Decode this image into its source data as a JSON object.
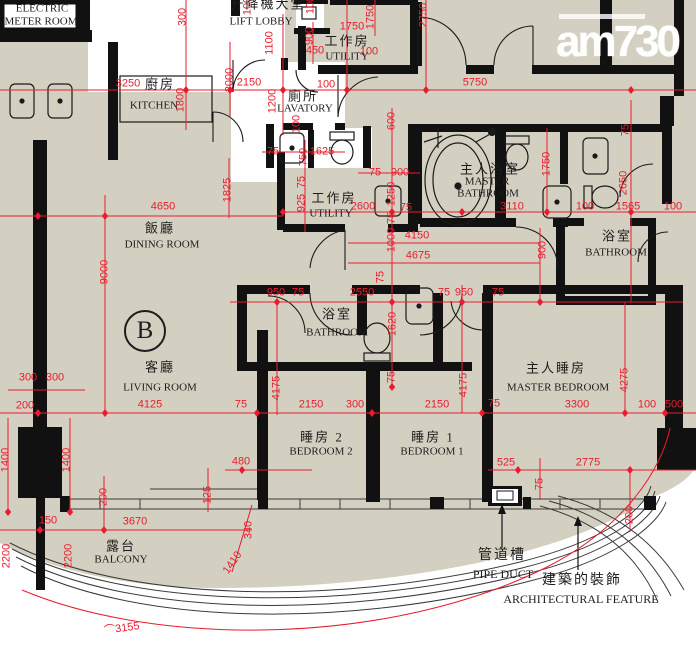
{
  "logo": {
    "text": "am730"
  },
  "unit_badge": {
    "text": "B"
  },
  "colors": {
    "floor": "#d4d0c1",
    "wall": "#111111",
    "dimension_red": "#ea1b2d",
    "logo_white": "#ffffff"
  },
  "rooms": [
    {
      "t": "ELECTRIC",
      "x": 42,
      "y": 9,
      "c": "en"
    },
    {
      "t": "METER ROOM",
      "x": 41,
      "y": 22,
      "c": "en"
    },
    {
      "t": "升降機大堂",
      "x": 268,
      "y": 4,
      "c": "zh"
    },
    {
      "t": "LIFT LOBBY",
      "x": 261,
      "y": 22,
      "c": "en"
    },
    {
      "t": "廚房",
      "x": 160,
      "y": 84,
      "c": "zh"
    },
    {
      "t": "KITCHEN",
      "x": 154,
      "y": 106,
      "c": "en"
    },
    {
      "t": "工作房",
      "x": 347,
      "y": 41,
      "c": "zh"
    },
    {
      "t": "UTILITY",
      "x": 347,
      "y": 57,
      "c": "en"
    },
    {
      "t": "廁所",
      "x": 303,
      "y": 96,
      "c": "zh"
    },
    {
      "t": "LAVATORY",
      "x": 305,
      "y": 109,
      "c": "en"
    },
    {
      "t": "主人浴室",
      "x": 490,
      "y": 169,
      "c": "zh"
    },
    {
      "t": "MASTER",
      "x": 487,
      "y": 182,
      "c": "en"
    },
    {
      "t": "BATHROOM",
      "x": 488,
      "y": 194,
      "c": "en"
    },
    {
      "t": "工作房",
      "x": 334,
      "y": 198,
      "c": "zh"
    },
    {
      "t": "UTILITY",
      "x": 331,
      "y": 214,
      "c": "en"
    },
    {
      "t": "浴室",
      "x": 617,
      "y": 236,
      "c": "zh"
    },
    {
      "t": "BATHROOM",
      "x": 616,
      "y": 253,
      "c": "en"
    },
    {
      "t": "飯廳",
      "x": 160,
      "y": 228,
      "c": "zh"
    },
    {
      "t": "DINING ROOM",
      "x": 162,
      "y": 245,
      "c": "en"
    },
    {
      "t": "浴室",
      "x": 337,
      "y": 314,
      "c": "zh"
    },
    {
      "t": "BATHROOM",
      "x": 337,
      "y": 333,
      "c": "en"
    },
    {
      "t": "客廳",
      "x": 160,
      "y": 367,
      "c": "zh"
    },
    {
      "t": "LIVING ROOM",
      "x": 160,
      "y": 388,
      "c": "en"
    },
    {
      "t": "主人睡房",
      "x": 556,
      "y": 368,
      "c": "zh"
    },
    {
      "t": "MASTER BEDROOM",
      "x": 558,
      "y": 388,
      "c": "en"
    },
    {
      "t": "睡房 2",
      "x": 322,
      "y": 437,
      "c": "zh"
    },
    {
      "t": "BEDROOM 2",
      "x": 321,
      "y": 452,
      "c": "en"
    },
    {
      "t": "睡房 1",
      "x": 433,
      "y": 437,
      "c": "zh"
    },
    {
      "t": "BEDROOM 1",
      "x": 432,
      "y": 452,
      "c": "en"
    },
    {
      "t": "露台",
      "x": 121,
      "y": 546,
      "c": "zh"
    },
    {
      "t": "BALCONY",
      "x": 121,
      "y": 560,
      "c": "en"
    }
  ],
  "annotations": [
    {
      "t": "管道槽",
      "x": 502,
      "y": 556,
      "c": "zh"
    },
    {
      "t": "PIPE DUCT",
      "x": 503,
      "y": 574,
      "c": "en"
    },
    {
      "t": "建築的裝飾",
      "x": 582,
      "y": 581,
      "c": "zh"
    },
    {
      "t": "ARCHITECTURAL FEATURE",
      "x": 581,
      "y": 599,
      "c": "en"
    }
  ],
  "dimensions": [
    {
      "t": "300",
      "x": 183,
      "y": 17,
      "r": -90
    },
    {
      "t": "100",
      "x": 248,
      "y": 6,
      "r": -90
    },
    {
      "t": "100",
      "x": 311,
      "y": 5,
      "r": -90
    },
    {
      "t": "1750",
      "x": 371,
      "y": 17,
      "r": -90
    },
    {
      "t": "2750",
      "x": 424,
      "y": 15,
      "r": -90
    },
    {
      "t": "3250",
      "x": 128,
      "y": 84
    },
    {
      "t": "1800",
      "x": 181,
      "y": 100,
      "r": -90
    },
    {
      "t": "2000",
      "x": 230,
      "y": 80,
      "r": -90
    },
    {
      "t": "1100",
      "x": 270,
      "y": 43,
      "r": -90
    },
    {
      "t": "900",
      "x": 310,
      "y": 36,
      "r": -90
    },
    {
      "t": "450",
      "x": 315,
      "y": 51
    },
    {
      "t": "1750",
      "x": 352,
      "y": 27
    },
    {
      "t": "100",
      "x": 369,
      "y": 52
    },
    {
      "t": "5750",
      "x": 475,
      "y": 83
    },
    {
      "t": "2150",
      "x": 249,
      "y": 83
    },
    {
      "t": "100",
      "x": 326,
      "y": 85
    },
    {
      "t": "1200",
      "x": 273,
      "y": 101,
      "r": -90
    },
    {
      "t": "100",
      "x": 297,
      "y": 124,
      "r": -90
    },
    {
      "t": "75",
      "x": 273,
      "y": 152
    },
    {
      "t": "1625",
      "x": 322,
      "y": 152
    },
    {
      "t": "600",
      "x": 392,
      "y": 121,
      "r": -90
    },
    {
      "t": "75",
      "x": 626,
      "y": 130,
      "r": -90
    },
    {
      "t": "1825",
      "x": 228,
      "y": 190,
      "r": -90
    },
    {
      "t": "750",
      "x": 304,
      "y": 157,
      "r": -90
    },
    {
      "t": "75",
      "x": 302,
      "y": 182,
      "r": -90
    },
    {
      "t": "925",
      "x": 302,
      "y": 203,
      "r": -90
    },
    {
      "t": "2600",
      "x": 363,
      "y": 207
    },
    {
      "t": "75",
      "x": 375,
      "y": 173
    },
    {
      "t": "900",
      "x": 400,
      "y": 173
    },
    {
      "t": "1250",
      "x": 392,
      "y": 194,
      "r": -90
    },
    {
      "t": "75",
      "x": 406,
      "y": 208
    },
    {
      "t": "75",
      "x": 392,
      "y": 218,
      "r": -90
    },
    {
      "t": "3110",
      "x": 512,
      "y": 207
    },
    {
      "t": "1750",
      "x": 547,
      "y": 164,
      "r": -90
    },
    {
      "t": "100",
      "x": 585,
      "y": 207
    },
    {
      "t": "1565",
      "x": 628,
      "y": 207
    },
    {
      "t": "100",
      "x": 673,
      "y": 207
    },
    {
      "t": "2650",
      "x": 624,
      "y": 183,
      "r": -90
    },
    {
      "t": "4650",
      "x": 163,
      "y": 207
    },
    {
      "t": "9000",
      "x": 105,
      "y": 272,
      "r": -90
    },
    {
      "t": "1000",
      "x": 392,
      "y": 240,
      "r": -90
    },
    {
      "t": "4150",
      "x": 417,
      "y": 236
    },
    {
      "t": "4675",
      "x": 418,
      "y": 256
    },
    {
      "t": "75",
      "x": 381,
      "y": 277,
      "r": -90
    },
    {
      "t": "900",
      "x": 543,
      "y": 250,
      "r": -90
    },
    {
      "t": "950",
      "x": 276,
      "y": 293
    },
    {
      "t": "75",
      "x": 298,
      "y": 293
    },
    {
      "t": "2550",
      "x": 362,
      "y": 293
    },
    {
      "t": "75",
      "x": 444,
      "y": 293
    },
    {
      "t": "950",
      "x": 464,
      "y": 293
    },
    {
      "t": "75",
      "x": 498,
      "y": 293
    },
    {
      "t": "1620",
      "x": 393,
      "y": 324,
      "r": -90
    },
    {
      "t": "75",
      "x": 392,
      "y": 377,
      "r": -90
    },
    {
      "t": "300",
      "x": 28,
      "y": 378
    },
    {
      "t": "300",
      "x": 55,
      "y": 378
    },
    {
      "t": "200",
      "x": 25,
      "y": 406
    },
    {
      "t": "4125",
      "x": 150,
      "y": 405
    },
    {
      "t": "4175",
      "x": 277,
      "y": 388,
      "r": -90
    },
    {
      "t": "4175",
      "x": 464,
      "y": 385,
      "r": -90
    },
    {
      "t": "4275",
      "x": 625,
      "y": 380,
      "r": -90
    },
    {
      "t": "75",
      "x": 241,
      "y": 405
    },
    {
      "t": "2150",
      "x": 311,
      "y": 405
    },
    {
      "t": "300",
      "x": 355,
      "y": 405
    },
    {
      "t": "2150",
      "x": 437,
      "y": 405
    },
    {
      "t": "75",
      "x": 494,
      "y": 404
    },
    {
      "t": "3300",
      "x": 577,
      "y": 405
    },
    {
      "t": "100",
      "x": 647,
      "y": 405
    },
    {
      "t": "500",
      "x": 674,
      "y": 405
    },
    {
      "t": "1400",
      "x": 6,
      "y": 460,
      "r": -90
    },
    {
      "t": "1400",
      "x": 67,
      "y": 460,
      "r": -90
    },
    {
      "t": "480",
      "x": 241,
      "y": 462
    },
    {
      "t": "525",
      "x": 506,
      "y": 463
    },
    {
      "t": "2775",
      "x": 588,
      "y": 463
    },
    {
      "t": "75",
      "x": 540,
      "y": 484,
      "r": -90
    },
    {
      "t": "200",
      "x": 104,
      "y": 497,
      "r": -90
    },
    {
      "t": "125",
      "x": 208,
      "y": 495,
      "r": -90
    },
    {
      "t": "200",
      "x": 630,
      "y": 515,
      "r": -90
    },
    {
      "t": "150",
      "x": 48,
      "y": 521
    },
    {
      "t": "3670",
      "x": 135,
      "y": 522
    },
    {
      "t": "2200",
      "x": 7,
      "y": 556,
      "r": -90
    },
    {
      "t": "2200",
      "x": 69,
      "y": 556,
      "r": -90
    },
    {
      "t": "340",
      "x": 249,
      "y": 530,
      "r": -90
    },
    {
      "t": "1410",
      "x": 233,
      "y": 563,
      "r": -55
    },
    {
      "t": "⌒3155",
      "x": 122,
      "y": 629,
      "r": -8
    }
  ]
}
